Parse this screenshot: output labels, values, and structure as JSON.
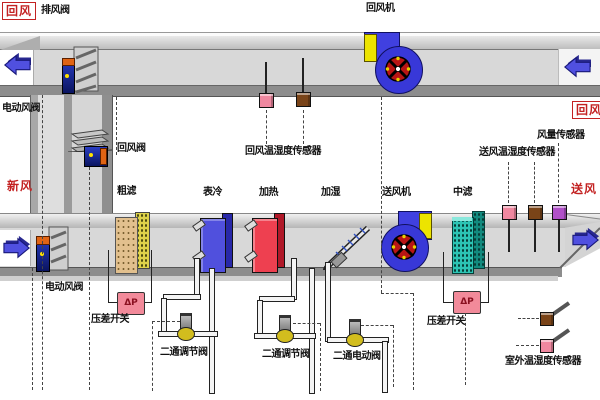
{
  "labels": {
    "return_air_top_left": "回风",
    "exhaust_valve": "排风阀",
    "return_fan": "回风机",
    "electric_damper_top": "电动风阀",
    "return_damper": "回风阀",
    "fresh_air": "新风",
    "coarse_filter": "粗滤",
    "cooling_coil": "表冷",
    "heating_coil": "加热",
    "humidifier": "加湿",
    "supply_fan": "送风机",
    "medium_filter": "中滤",
    "return_temp_humidity_sensor": "回风温湿度传感器",
    "airflow_sensor": "风量传感器",
    "supply_temp_humidity_sensor": "送风温湿度传感器",
    "return_air_right": "回风",
    "supply_air": "送风",
    "electric_damper_bottom": "电动风阀",
    "dp_switch_left": "压差开关",
    "dp_switch_right": "压差开关",
    "two_way_regulating_valve_1": "二通调节阀",
    "two_way_regulating_valve_2": "二通调节阀",
    "two_way_electric_valve": "二通电动阀",
    "outdoor_temp_humidity_sensor": "室外温湿度传感器",
    "dp_symbol": "ΔP"
  },
  "colors": {
    "accent_red": "#c32222",
    "duct_gray": "#d8d8d8",
    "duct_dark_gray": "#8d8d8d",
    "arrow_blue": "#5050e0",
    "fan_blue": "#3838d8",
    "fan_yellow": "#ece400",
    "impeller_red": "#b81515",
    "coarse_filter_tan": "#e2c08e",
    "coarse_filter_yellow": "#ded24a",
    "cooling_coil_blue": "#5050dd",
    "heating_coil_red": "#ee4050",
    "medium_filter_teal": "#2cc4b4",
    "sensor_pink": "#f088a0",
    "sensor_brown": "#7a4418",
    "sensor_purple": "#b050c8",
    "dp_box_pink": "#f28a9a",
    "valve_yellow": "#d2bd1e"
  }
}
